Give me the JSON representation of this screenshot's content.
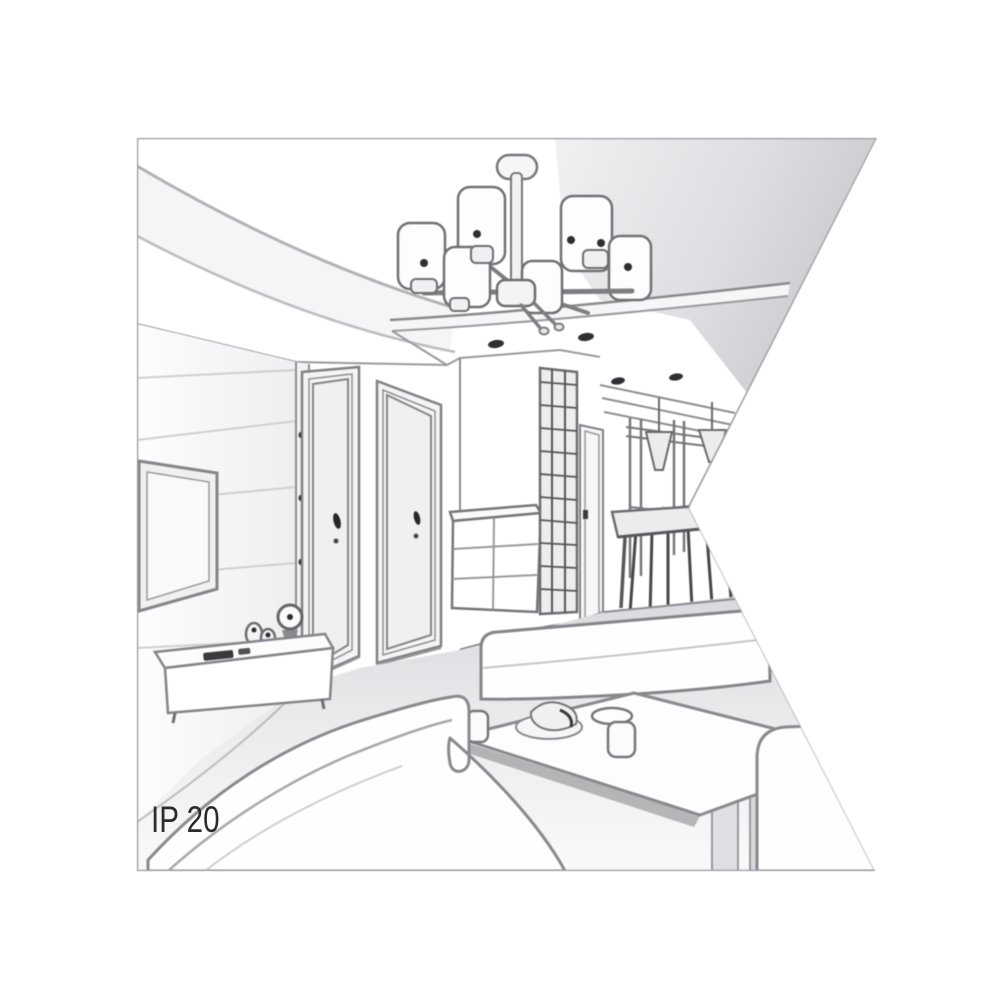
{
  "page": {
    "background": "#ffffff"
  },
  "label": {
    "text": "IP 20",
    "color": "#2b2b2b"
  },
  "illustration": {
    "type": "interior-room-line-art",
    "style": "grayscale perspective sketch clipped by arrow-notch shape on right edge",
    "line_color": "#7a7a7e",
    "dark_accent": "#2e2e32",
    "ceiling_shade": "#cdcdd2",
    "floor_shade": "#dcdce0",
    "elements": [
      "ceiling-chandelier-six-cylinder-shades",
      "recessed-ceiling-spotlights",
      "curved-cove-ceiling",
      "paneled-tv-wall",
      "wall-mounted-tv",
      "interior-door-left",
      "interior-door-right",
      "hallway-chest-of-drawers",
      "slatted-wardrobe",
      "hallway-door",
      "dining-glass-door",
      "cone-pendant-lamps",
      "dining-table-with-chairs",
      "main-sofa",
      "back-sofa",
      "right-sofa-armrest",
      "coffee-table-with-cups-and-plate",
      "tv-console-with-clock-and-speakers"
    ]
  }
}
